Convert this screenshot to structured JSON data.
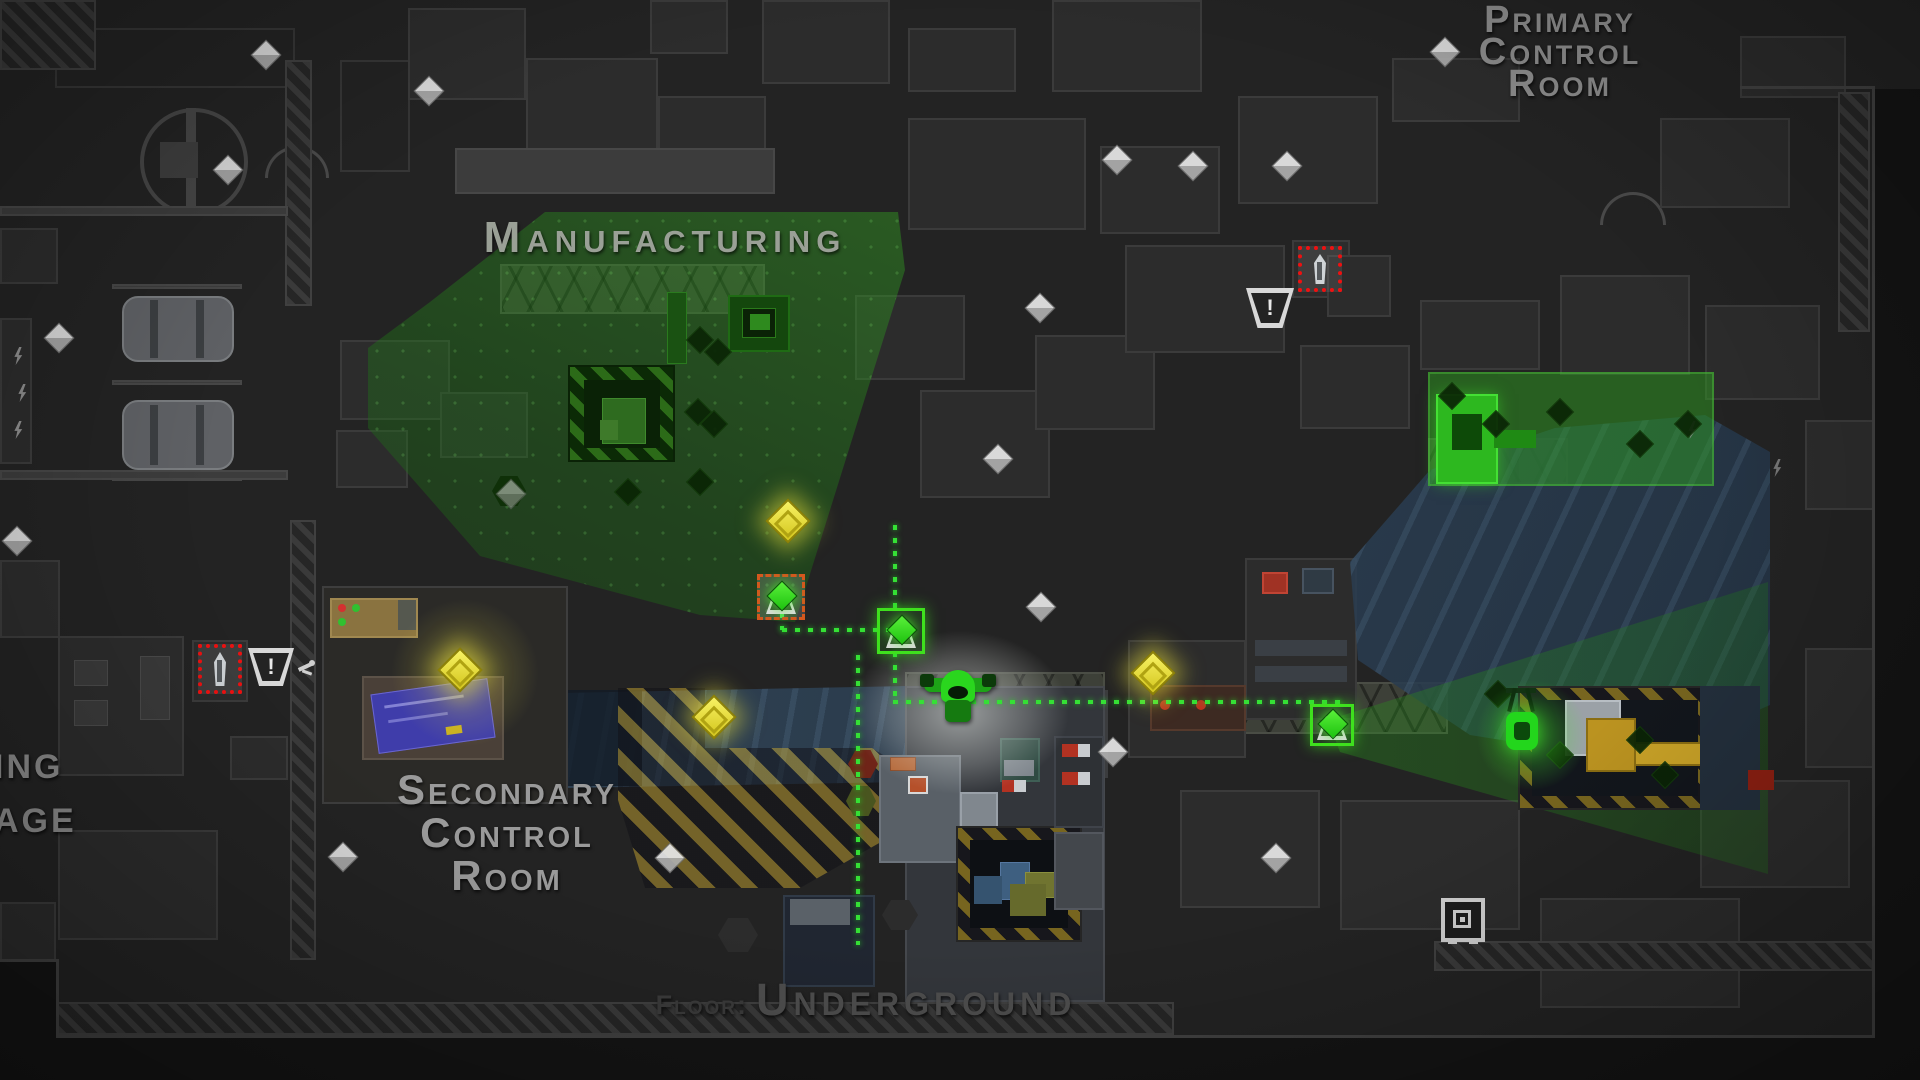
{
  "rooms": {
    "primary": [
      "Primary",
      "Control",
      "Room"
    ],
    "manufacturing": "Manufacturing",
    "secondary": [
      "Secondary",
      "Control",
      "Room"
    ],
    "left_fragment": [
      "ing",
      "age"
    ],
    "floor": {
      "label": "Floor:",
      "value": "Underground"
    }
  },
  "colors": {
    "cone_green": "#2fae1f",
    "loot_yellow": "#e8df3a",
    "alert_red": "#ee1414",
    "path_green": "#35e035",
    "coin_white": "#d9d9d9",
    "blueprint_blue": "#3f3daa",
    "water_blue": "#3a5268",
    "hazard_yellow": "#c9a227",
    "label_gray": "#919191",
    "background": "#232323"
  },
  "markers": {
    "player": {
      "x": 920,
      "y": 664,
      "w": 76,
      "h": 66
    },
    "worker": {
      "x": 1500,
      "y": 686,
      "w": 44,
      "h": 70
    },
    "guards": [
      {
        "x": 1298,
        "y": 246,
        "w": 44,
        "h": 46
      },
      {
        "x": 198,
        "y": 644,
        "w": 44,
        "h": 50
      }
    ],
    "warnings": [
      {
        "x": 1246,
        "y": 288,
        "w": 48,
        "h": 40
      },
      {
        "x": 248,
        "y": 648,
        "w": 46,
        "h": 38
      }
    ],
    "dog": {
      "x": 298,
      "y": 658,
      "w": 18,
      "h": 22
    },
    "safe": {
      "x": 1441,
      "y": 898,
      "w": 44,
      "h": 44
    },
    "objectives": [
      {
        "x": 757,
        "y": 574,
        "w": 48,
        "h": 46,
        "style": "dashed"
      },
      {
        "x": 877,
        "y": 608,
        "w": 48,
        "h": 46,
        "style": "solid"
      },
      {
        "x": 1310,
        "y": 704,
        "w": 44,
        "h": 42,
        "style": "solid"
      }
    ],
    "coins": [
      [
        266,
        55
      ],
      [
        429,
        91
      ],
      [
        228,
        170
      ],
      [
        59,
        338
      ],
      [
        17,
        541
      ],
      [
        511,
        494,
        1
      ],
      [
        1040,
        308
      ],
      [
        998,
        459
      ],
      [
        1041,
        607
      ],
      [
        1117,
        160
      ],
      [
        1193,
        166
      ],
      [
        1287,
        166
      ],
      [
        1445,
        52
      ],
      [
        1113,
        752
      ],
      [
        1276,
        858
      ],
      [
        343,
        857
      ],
      [
        670,
        858
      ]
    ],
    "loot": [
      [
        460,
        670
      ],
      [
        788,
        521
      ],
      [
        714,
        717
      ],
      [
        1153,
        673
      ]
    ]
  },
  "path": {
    "segments": [
      [
        893,
        525,
        86,
        "v"
      ],
      [
        782,
        628,
        112,
        "h"
      ],
      [
        780,
        600,
        30,
        "v"
      ],
      [
        893,
        652,
        50,
        "v"
      ],
      [
        893,
        700,
        452,
        "h"
      ],
      [
        856,
        655,
        290,
        "v"
      ]
    ]
  }
}
